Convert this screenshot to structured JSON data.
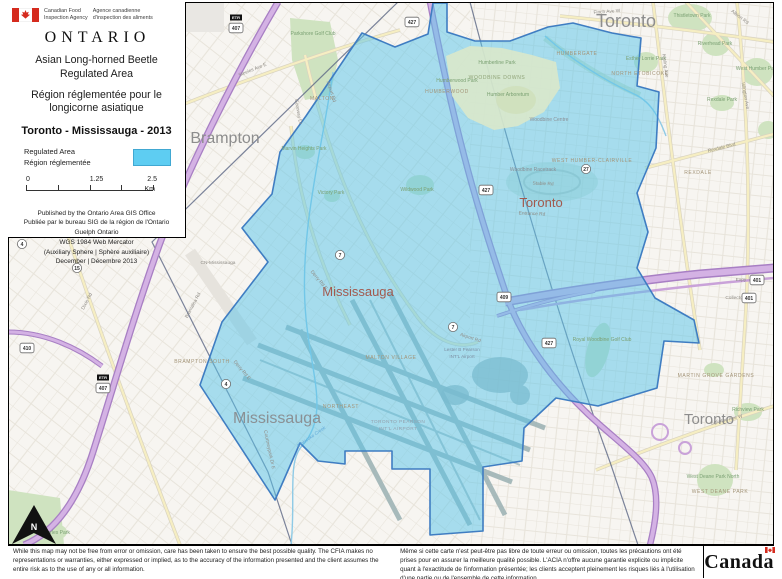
{
  "header": {
    "agency_en": [
      "Canadian Food",
      "Inspection Agency"
    ],
    "agency_fr": [
      "Agence canadienne",
      "d'inspection des aliments"
    ]
  },
  "legend": {
    "region": "ONTARIO",
    "title_en": [
      "Asian Long-horned Beetle",
      "Regulated Area"
    ],
    "title_fr": [
      "Région réglementée pour le",
      "longicorne asiatique"
    ],
    "map_title": "Toronto - Mississauga - 2013",
    "regulated_label_en": "Regulated Area",
    "regulated_label_fr": "Région réglementée",
    "scale": {
      "t0": "0",
      "t1": "1.25",
      "t2": "2.5",
      "unit": "Km"
    },
    "publisher": [
      "Published by the Ontario Area GIS Office",
      "Publiée par le bureau SIG de la région de l'Ontario",
      "Guelph Ontario",
      "WGS 1984 Web Mercator",
      "(Auxiliary Sphere | Sphère auxiliaire)",
      "December | Décembre 2013"
    ]
  },
  "footer": {
    "disclaimer_en": "While this map may not be free from error or omission, care has been taken to ensure the best possible quality. The CFIA makes no representations or warranties, either expressed or implied, as to the accuracy of the information presented and the client assumes the entire risk as to the use of any or all information.",
    "disclaimer_fr": "Même si cette carte n'est peut-être pas libre de toute erreur ou omission, toutes les précautions ont été prises pour en assurer la meilleure qualité possible. L'ACIA n'offre aucune garantie explicite ou implicite quant à l'exactitude de l'information présentée; les clients acceptent pleinement les risques liés à l'utilisation d'une partie ou de l'ensemble de cette information.",
    "wordmark": "Canada"
  },
  "colors": {
    "regulated_fill": "#56c3ea",
    "regulated_border": "#3f7dc2",
    "highway": "#c9a2d9",
    "park": "#cfe3c0"
  },
  "map": {
    "north": "N",
    "etr_tag": "ETR",
    "labels": [
      {
        "t": "Toronto",
        "x": 626,
        "y": 27,
        "k": "lc",
        "s": 18
      },
      {
        "t": "Brampton",
        "x": 225,
        "y": 143,
        "k": "lc",
        "s": 16
      },
      {
        "t": "Toronto",
        "x": 709,
        "y": 424,
        "k": "lc",
        "s": 15
      },
      {
        "t": "Mississauga",
        "x": 277,
        "y": 423,
        "k": "lcb",
        "s": 16
      },
      {
        "t": "Mississauga",
        "x": 358,
        "y": 296,
        "k": "lci",
        "s": 13
      },
      {
        "t": "Toronto",
        "x": 541,
        "y": 207,
        "k": "lci",
        "s": 13
      },
      {
        "t": "MALTON",
        "x": 322,
        "y": 100,
        "k": "la"
      },
      {
        "t": "MALTON VILLAGE",
        "x": 391,
        "y": 359,
        "k": "la"
      },
      {
        "t": "BRAMPTON SOUTH",
        "x": 202,
        "y": 363,
        "k": "la"
      },
      {
        "t": "NORTHEAST",
        "x": 341,
        "y": 408,
        "k": "la"
      },
      {
        "t": "HUMBERWOOD",
        "x": 447,
        "y": 93,
        "k": "la"
      },
      {
        "t": "NORTH ETOBICOKE",
        "x": 640,
        "y": 75,
        "k": "la"
      },
      {
        "t": "HUMBERGATE",
        "x": 577,
        "y": 55,
        "k": "la"
      },
      {
        "t": "WEST HUMBER-CLAIRVILLE",
        "x": 592,
        "y": 162,
        "k": "la"
      },
      {
        "t": "REXDALE",
        "x": 698,
        "y": 174,
        "k": "la"
      },
      {
        "t": "MARTIN GROVE GARDENS",
        "x": 716,
        "y": 377,
        "k": "la"
      },
      {
        "t": "WEST DEANE PARK",
        "x": 720,
        "y": 493,
        "k": "la"
      },
      {
        "t": "WOODBINE DOWNS",
        "x": 497,
        "y": 79,
        "k": "lag"
      },
      {
        "t": "CN-Mississauga",
        "x": 218,
        "y": 264,
        "k": "lr"
      },
      {
        "t": "Humberline Park",
        "x": 497,
        "y": 64,
        "k": "lp"
      },
      {
        "t": "Humberwood Park",
        "x": 457,
        "y": 82,
        "k": "lp"
      },
      {
        "t": "Humber Arboretum",
        "x": 508,
        "y": 96,
        "k": "lp"
      },
      {
        "t": "Esther Lorrie Park",
        "x": 646,
        "y": 60,
        "k": "lp"
      },
      {
        "t": "Thistletown Park",
        "x": 692,
        "y": 17,
        "k": "lp"
      },
      {
        "t": "Riverhead Park",
        "x": 715,
        "y": 45,
        "k": "lp"
      },
      {
        "t": "West Humber Park",
        "x": 757,
        "y": 70,
        "k": "lp"
      },
      {
        "t": "Rexdale Park",
        "x": 722,
        "y": 101,
        "k": "lp"
      },
      {
        "t": "Parkshore Golf Club",
        "x": 313,
        "y": 35,
        "k": "lp"
      },
      {
        "t": "Royal Woodbine Golf Club",
        "x": 602,
        "y": 341,
        "k": "lp"
      },
      {
        "t": "Richview Park",
        "x": 748,
        "y": 411,
        "k": "lp"
      },
      {
        "t": "West Deane Park North",
        "x": 713,
        "y": 478,
        "k": "lp"
      },
      {
        "t": "Marvin Heights Park",
        "x": 304,
        "y": 150,
        "k": "lp"
      },
      {
        "t": "Victory Park",
        "x": 331,
        "y": 194,
        "k": "lp"
      },
      {
        "t": "Wildwood Park",
        "x": 417,
        "y": 191,
        "k": "lp"
      },
      {
        "t": "Mt Charles Park",
        "x": 52,
        "y": 534,
        "k": "lp"
      },
      {
        "t": "Woodbine Racetrack",
        "x": 533,
        "y": 171,
        "k": "lv"
      },
      {
        "t": "Woodbine Centre",
        "x": 549,
        "y": 121,
        "k": "lv"
      },
      {
        "t": "Lester B Pearson",
        "x": 462,
        "y": 351,
        "k": "lap"
      },
      {
        "t": "INT'L Airport",
        "x": 462,
        "y": 358,
        "k": "lap"
      },
      {
        "t": "TORONTO PEARSON",
        "x": 398,
        "y": 423,
        "k": "lap2"
      },
      {
        "t": "INT'L AIRPORT",
        "x": 398,
        "y": 430,
        "k": "lap2"
      },
      {
        "t": "Finch Ave W",
        "x": 607,
        "y": 13,
        "k": "lr",
        "r": -4
      },
      {
        "t": "Steeles Ave E",
        "x": 253,
        "y": 71,
        "k": "lr",
        "r": -22
      },
      {
        "t": "Goreway Dr",
        "x": 297,
        "y": 112,
        "k": "lr",
        "r": 80
      },
      {
        "t": "Airport Rd",
        "x": 330,
        "y": 92,
        "k": "lr",
        "r": 72
      },
      {
        "t": "Airport Rd",
        "x": 470,
        "y": 339,
        "k": "lr",
        "r": 18
      },
      {
        "t": "Derry Rd E",
        "x": 241,
        "y": 371,
        "k": "lr",
        "r": 50
      },
      {
        "t": "Derry Rd E",
        "x": 318,
        "y": 281,
        "k": "lr",
        "r": 50
      },
      {
        "t": "Dixie Rd",
        "x": 88,
        "y": 302,
        "k": "lr",
        "r": -62
      },
      {
        "t": "Kipling Ave",
        "x": 664,
        "y": 66,
        "k": "lr",
        "r": 82
      },
      {
        "t": "Islington Ave",
        "x": 744,
        "y": 96,
        "k": "lr",
        "r": 80
      },
      {
        "t": "Albion Rd",
        "x": 739,
        "y": 18,
        "k": "lr",
        "r": 38
      },
      {
        "t": "Rexdale Blvd",
        "x": 722,
        "y": 149,
        "k": "lr",
        "r": -14
      },
      {
        "t": "Eglinton Ave W",
        "x": 727,
        "y": 421,
        "k": "lr",
        "r": -13
      },
      {
        "t": "Entrance Rd",
        "x": 532,
        "y": 215,
        "k": "lr",
        "r": 2
      },
      {
        "t": "Stable Rd",
        "x": 543,
        "y": 185,
        "k": "lr",
        "r": 2
      },
      {
        "t": "Courtneypark Dr E",
        "x": 268,
        "y": 450,
        "k": "lr",
        "r": 78
      },
      {
        "t": "Bramalea Rd",
        "x": 194,
        "y": 306,
        "k": "lr",
        "r": -62
      },
      {
        "t": "Expy",
        "x": 741,
        "y": 281,
        "k": "lr"
      },
      {
        "t": "Collectors",
        "x": 736,
        "y": 299,
        "k": "lr"
      },
      {
        "t": "Etobicoke Creek",
        "x": 312,
        "y": 438,
        "k": "lw",
        "r": -35
      }
    ],
    "shields": [
      {
        "n": "407",
        "x": 236,
        "y": 28,
        "t": "etr"
      },
      {
        "n": "407",
        "x": 103,
        "y": 388,
        "t": "etr"
      },
      {
        "n": "427",
        "x": 412,
        "y": 22,
        "t": "p"
      },
      {
        "n": "427",
        "x": 486,
        "y": 190,
        "t": "p"
      },
      {
        "n": "427",
        "x": 549,
        "y": 343,
        "t": "p"
      },
      {
        "n": "401",
        "x": 757,
        "y": 280,
        "t": "p"
      },
      {
        "n": "401",
        "x": 749,
        "y": 298,
        "t": "p"
      },
      {
        "n": "409",
        "x": 504,
        "y": 297,
        "t": "p"
      },
      {
        "n": "410",
        "x": 27,
        "y": 348,
        "t": "p"
      },
      {
        "n": "7",
        "x": 340,
        "y": 255,
        "t": "c"
      },
      {
        "n": "7",
        "x": 453,
        "y": 327,
        "t": "c"
      },
      {
        "n": "27",
        "x": 586,
        "y": 169,
        "t": "c"
      },
      {
        "n": "4",
        "x": 226,
        "y": 384,
        "t": "c"
      },
      {
        "n": "4",
        "x": 22,
        "y": 244,
        "t": "c"
      },
      {
        "n": "15",
        "x": 77,
        "y": 268,
        "t": "c"
      }
    ]
  }
}
